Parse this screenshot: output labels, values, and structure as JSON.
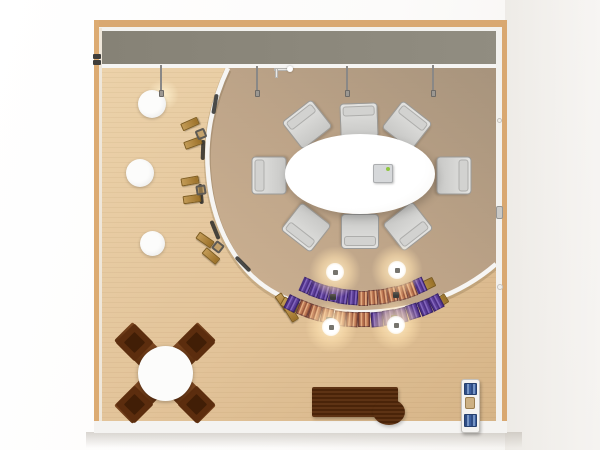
{
  "scene": {
    "view": "top-down 3d render of a conference room floor plan, no visible text",
    "palette": {
      "wood_trim": "#d9a871",
      "wall_gray": "#8b8779",
      "floor_light": "#e5c89f",
      "floor_light_2": "#d8b78c",
      "floor_inner": "#ab977f",
      "floor_inner_2": "#cbb08f",
      "partition_white": "#f6f5f3",
      "purple_dark": "#4c2f85",
      "purple_light": "#8366bc",
      "coral_dark": "#9c5a3e",
      "coral_light": "#e2aa80",
      "tan_desk": "#b08440",
      "walnut": "#53290c",
      "book_blue": "#3c5f9e",
      "book_blue_dark": "#2f4d85",
      "chair_gray": "#d5d5d3",
      "chair_edge": "#9b9b99",
      "device_led": "#8fc641",
      "glow": "#ffe3b3"
    },
    "seat_rows": [
      {
        "name": "auditorium-row-1",
        "cx": 363,
        "cy": 157,
        "r": 141,
        "a_start": 116,
        "a_end": 64,
        "count": 13,
        "seat_w": 10,
        "seat_h": 15,
        "pattern": [
          "P",
          "P",
          "P",
          "P",
          "P",
          "P",
          "C",
          "C",
          "C",
          "C",
          "C",
          "C",
          "P"
        ]
      },
      {
        "name": "auditorium-row-2",
        "cx": 363,
        "cy": 160,
        "r": 160,
        "a_start": 118.5,
        "a_end": 60.5,
        "count": 13,
        "seat_w": 12,
        "seat_h": 15,
        "pattern": [
          "P",
          "C",
          "C",
          "C",
          "C",
          "C",
          "C",
          "P",
          "P",
          "P",
          "P",
          "P",
          "P"
        ]
      }
    ],
    "items": [
      {
        "name": "pendant-glow",
        "cls": "glow-warm",
        "cx": 163,
        "cy": 95,
        "w": 34,
        "h": 30,
        "z": 2,
        "inter": false
      },
      {
        "name": "stool-1",
        "cls": "stool",
        "cx": 152,
        "cy": 104,
        "w": 28,
        "h": 28,
        "z": 3,
        "inter": true
      },
      {
        "name": "stool-2",
        "cls": "stool",
        "cx": 140,
        "cy": 173,
        "w": 28,
        "h": 28,
        "z": 3,
        "inter": true
      },
      {
        "name": "stool-3",
        "cls": "stool",
        "cx": 152,
        "cy": 243,
        "w": 25,
        "h": 25,
        "z": 3,
        "inter": true
      },
      {
        "name": "pendant-stem-1",
        "cls": "stem",
        "cx": 161,
        "cy": 78,
        "w": 2,
        "h": 27,
        "z": 5,
        "inter": false
      },
      {
        "name": "pendant-bulb-1",
        "cls": "bulb",
        "cx": 161,
        "cy": 93,
        "w": 5,
        "h": 7,
        "z": 5,
        "inter": true
      },
      {
        "name": "pendant-stem-2",
        "cls": "stem",
        "cx": 257,
        "cy": 79,
        "w": 2,
        "h": 27,
        "z": 5,
        "inter": false
      },
      {
        "name": "pendant-bulb-2",
        "cls": "bulb",
        "cx": 257,
        "cy": 93,
        "w": 5,
        "h": 7,
        "z": 5,
        "inter": true
      },
      {
        "name": "pendant-stem-3",
        "cls": "stem",
        "cx": 347,
        "cy": 79,
        "w": 2,
        "h": 27,
        "z": 5,
        "inter": false
      },
      {
        "name": "pendant-bulb-3",
        "cls": "bulb",
        "cx": 347,
        "cy": 93,
        "w": 5,
        "h": 7,
        "z": 5,
        "inter": true
      },
      {
        "name": "pendant-stem-4",
        "cls": "stem",
        "cx": 433,
        "cy": 78,
        "w": 2,
        "h": 27,
        "z": 5,
        "inter": false
      },
      {
        "name": "pendant-bulb-4",
        "cls": "bulb",
        "cx": 433,
        "cy": 93,
        "w": 5,
        "h": 7,
        "z": 5,
        "inter": true
      },
      {
        "name": "wall-bracket-arm",
        "cls": "bracket",
        "cx": 282,
        "cy": 69,
        "w": 16,
        "h": 3,
        "z": 5,
        "inter": false
      },
      {
        "name": "wall-bracket-post",
        "cls": "bracket",
        "cx": 276,
        "cy": 73,
        "w": 3,
        "h": 10,
        "z": 5,
        "inter": false
      },
      {
        "name": "wall-bracket-ball",
        "cls": "ball",
        "cx": 290,
        "cy": 69,
        "w": 6,
        "h": 6,
        "z": 5,
        "inter": false
      },
      {
        "name": "conference-table",
        "cls": "oval-table",
        "cx": 360,
        "cy": 174,
        "w": 150,
        "h": 80,
        "z": 4,
        "inter": true
      },
      {
        "name": "table-device",
        "cls": "device",
        "cx": 383,
        "cy": 173,
        "w": 20,
        "h": 19,
        "z": 5,
        "inter": true
      },
      {
        "name": "conference-chair-1",
        "cls": "chair",
        "cx": 307,
        "cy": 124,
        "w": 38,
        "h": 35,
        "rot": -38,
        "z": 3,
        "inter": true
      },
      {
        "name": "conference-chair-2",
        "cls": "chair",
        "cx": 359,
        "cy": 120,
        "w": 38,
        "h": 35,
        "rot": -2,
        "z": 3,
        "inter": true
      },
      {
        "name": "conference-chair-3",
        "cls": "chair",
        "cx": 407,
        "cy": 125,
        "w": 38,
        "h": 35,
        "rot": 38,
        "z": 3,
        "inter": true
      },
      {
        "name": "conference-chair-4",
        "cls": "chair",
        "cx": 269,
        "cy": 175,
        "w": 38,
        "h": 35,
        "rot": -90,
        "z": 3,
        "inter": true
      },
      {
        "name": "conference-chair-5",
        "cls": "chair",
        "cx": 454,
        "cy": 175,
        "w": 38,
        "h": 35,
        "rot": 90,
        "z": 3,
        "inter": true
      },
      {
        "name": "conference-chair-6",
        "cls": "chair",
        "cx": 306,
        "cy": 227,
        "w": 38,
        "h": 35,
        "rot": -142,
        "z": 3,
        "inter": true
      },
      {
        "name": "conference-chair-7",
        "cls": "chair",
        "cx": 360,
        "cy": 231,
        "w": 38,
        "h": 35,
        "rot": 180,
        "z": 3,
        "inter": true
      },
      {
        "name": "conference-chair-8",
        "cls": "chair",
        "cx": 408,
        "cy": 226,
        "w": 38,
        "h": 35,
        "rot": 142,
        "z": 3,
        "inter": true
      },
      {
        "name": "curve-desk-1a",
        "cls": "slat",
        "cx": 190,
        "cy": 124,
        "w": 18,
        "h": 8,
        "rot": -24,
        "z": 3,
        "inter": true
      },
      {
        "name": "curve-desk-1b",
        "cls": "slat",
        "cx": 193,
        "cy": 143,
        "w": 18,
        "h": 8,
        "rot": -20,
        "z": 3,
        "inter": true
      },
      {
        "name": "curve-chair-1",
        "cls": "mini-chair",
        "cx": 201,
        "cy": 134,
        "w": 10,
        "h": 10,
        "rot": -22,
        "z": 3,
        "inter": true
      },
      {
        "name": "curve-desk-2a",
        "cls": "slat",
        "cx": 190,
        "cy": 181,
        "w": 18,
        "h": 8,
        "rot": -10,
        "z": 3,
        "inter": true
      },
      {
        "name": "curve-desk-2b",
        "cls": "slat",
        "cx": 192,
        "cy": 199,
        "w": 18,
        "h": 8,
        "rot": -8,
        "z": 3,
        "inter": true
      },
      {
        "name": "curve-chair-2",
        "cls": "mini-chair",
        "cx": 201,
        "cy": 190,
        "w": 10,
        "h": 10,
        "rot": -9,
        "z": 3,
        "inter": true
      },
      {
        "name": "curve-desk-3a",
        "cls": "slat",
        "cx": 205,
        "cy": 240,
        "w": 18,
        "h": 8,
        "rot": 35,
        "z": 3,
        "inter": true
      },
      {
        "name": "curve-desk-3b",
        "cls": "slat",
        "cx": 211,
        "cy": 256,
        "w": 18,
        "h": 8,
        "rot": 40,
        "z": 3,
        "inter": true
      },
      {
        "name": "curve-chair-3",
        "cls": "mini-chair",
        "cx": 218,
        "cy": 247,
        "w": 10,
        "h": 10,
        "rot": 38,
        "z": 3,
        "inter": true
      },
      {
        "name": "curve-desk-4a",
        "cls": "slat",
        "cx": 283,
        "cy": 302,
        "w": 18,
        "h": 8,
        "rot": 55,
        "z": 3,
        "inter": true
      },
      {
        "name": "curve-desk-4b",
        "cls": "slat",
        "cx": 291,
        "cy": 313,
        "w": 18,
        "h": 8,
        "rot": 58,
        "z": 3,
        "inter": true
      },
      {
        "name": "curve-chair-4",
        "cls": "mini-chair",
        "cx": 296,
        "cy": 306,
        "w": 10,
        "h": 10,
        "rot": 56,
        "z": 3,
        "inter": true
      },
      {
        "name": "inner-trim-1",
        "cls": "dark-arc",
        "cx": 215,
        "cy": 104,
        "w": 20,
        "h": 4,
        "rot": 100,
        "z": 2,
        "inter": false
      },
      {
        "name": "inner-trim-2",
        "cls": "dark-arc",
        "cx": 203,
        "cy": 150,
        "w": 20,
        "h": 4,
        "rot": 92,
        "z": 2,
        "inter": false
      },
      {
        "name": "inner-trim-3",
        "cls": "dark-arc",
        "cx": 201,
        "cy": 194,
        "w": 20,
        "h": 4,
        "rot": 85,
        "z": 2,
        "inter": false
      },
      {
        "name": "inner-trim-4",
        "cls": "dark-arc",
        "cx": 215,
        "cy": 230,
        "w": 20,
        "h": 4,
        "rot": 68,
        "z": 2,
        "inter": false
      },
      {
        "name": "inner-trim-5",
        "cls": "dark-arc",
        "cx": 243,
        "cy": 264,
        "w": 20,
        "h": 4,
        "rot": 45,
        "z": 2,
        "inter": false
      },
      {
        "name": "cafe-x-bar-1",
        "cls": "xbar",
        "cx": 165,
        "cy": 373,
        "w": 118,
        "h": 26,
        "rot": 45,
        "z": 2,
        "inter": true
      },
      {
        "name": "cafe-x-bar-2",
        "cls": "xbar",
        "cx": 165,
        "cy": 373,
        "w": 118,
        "h": 26,
        "rot": -45,
        "z": 2,
        "inter": true
      },
      {
        "name": "cafe-seat-1",
        "cls": "diamond",
        "cx": 134,
        "cy": 342,
        "w": 27,
        "h": 27,
        "rot": 45,
        "z": 3,
        "inter": true
      },
      {
        "name": "cafe-seat-2",
        "cls": "diamond",
        "cx": 196,
        "cy": 342,
        "w": 27,
        "h": 27,
        "rot": 45,
        "z": 3,
        "inter": true
      },
      {
        "name": "cafe-seat-3",
        "cls": "diamond",
        "cx": 134,
        "cy": 404,
        "w": 27,
        "h": 27,
        "rot": 45,
        "z": 3,
        "inter": true
      },
      {
        "name": "cafe-seat-4",
        "cls": "diamond",
        "cx": 196,
        "cy": 404,
        "w": 27,
        "h": 27,
        "rot": 45,
        "z": 3,
        "inter": true
      },
      {
        "name": "cafe-seat-1-cushion",
        "cls": "diamond-inner",
        "cx": 134,
        "cy": 342,
        "w": 15,
        "h": 15,
        "rot": 45,
        "z": 3,
        "inter": false
      },
      {
        "name": "cafe-seat-2-cushion",
        "cls": "diamond-inner",
        "cx": 196,
        "cy": 342,
        "w": 15,
        "h": 15,
        "rot": 45,
        "z": 3,
        "inter": false
      },
      {
        "name": "cafe-seat-3-cushion",
        "cls": "diamond-inner",
        "cx": 134,
        "cy": 404,
        "w": 15,
        "h": 15,
        "rot": 45,
        "z": 3,
        "inter": false
      },
      {
        "name": "cafe-seat-4-cushion",
        "cls": "diamond-inner",
        "cx": 196,
        "cy": 404,
        "w": 15,
        "h": 15,
        "rot": 45,
        "z": 3,
        "inter": false
      },
      {
        "name": "cafe-round-table",
        "cls": "circle-table",
        "cx": 165,
        "cy": 373,
        "w": 55,
        "h": 55,
        "z": 4,
        "inter": true
      },
      {
        "name": "credenza-desk",
        "cls": "desk",
        "cx": 355,
        "cy": 402,
        "w": 86,
        "h": 30,
        "z": 3,
        "inter": true
      },
      {
        "name": "credenza-desk-bulge",
        "cls": "desk-bulge",
        "cx": 389,
        "cy": 412,
        "w": 32,
        "h": 26,
        "z": 3,
        "inter": false
      },
      {
        "name": "bookshelf",
        "cls": "shelf",
        "cx": 470,
        "cy": 406,
        "w": 19,
        "h": 54,
        "z": 3,
        "inter": true
      },
      {
        "name": "bookshelf-books-top",
        "cls": "books",
        "cx": 470,
        "cy": 389,
        "w": 13,
        "h": 12,
        "z": 4,
        "inter": false
      },
      {
        "name": "bookshelf-plant",
        "cls": "plant",
        "cx": 470,
        "cy": 403,
        "w": 10,
        "h": 12,
        "z": 4,
        "inter": false
      },
      {
        "name": "bookshelf-books-bottom",
        "cls": "books",
        "cx": 470,
        "cy": 420,
        "w": 13,
        "h": 13,
        "z": 4,
        "inter": false
      },
      {
        "name": "door-handle",
        "cls": "handle",
        "cx": 499,
        "cy": 212,
        "w": 7,
        "h": 13,
        "z": 4,
        "inter": true
      },
      {
        "name": "wall-knob-1",
        "cls": "wall-dot",
        "cx": 499,
        "cy": 120,
        "w": 5,
        "h": 5,
        "z": 4,
        "inter": false
      },
      {
        "name": "wall-knob-2",
        "cls": "wall-dot",
        "cx": 500,
        "cy": 287,
        "w": 6,
        "h": 6,
        "z": 4,
        "inter": false
      },
      {
        "name": "wall-latch-1",
        "cls": "latch",
        "cx": 97,
        "cy": 56,
        "w": 8,
        "h": 5,
        "z": 4,
        "inter": false
      },
      {
        "name": "wall-latch-2",
        "cls": "latch",
        "cx": 97,
        "cy": 62,
        "w": 8,
        "h": 5,
        "z": 4,
        "inter": false
      },
      {
        "name": "row-end-table-1",
        "cls": "cap",
        "cx": 426,
        "cy": 285,
        "w": 17,
        "h": 10,
        "rot": -26,
        "z": 4,
        "inter": true
      },
      {
        "name": "row-end-table-2",
        "cls": "cap",
        "cx": 289,
        "cy": 305,
        "w": 17,
        "h": 10,
        "rot": 30,
        "z": 4,
        "inter": true
      },
      {
        "name": "row-end-table-3",
        "cls": "cap",
        "cx": 439,
        "cy": 302,
        "w": 17,
        "h": 10,
        "rot": -32,
        "z": 4,
        "inter": true
      },
      {
        "name": "row-connector-1",
        "cls": "connector",
        "cx": 333,
        "cy": 297,
        "w": 6,
        "h": 6,
        "z": 5,
        "inter": false
      },
      {
        "name": "row-connector-2",
        "cls": "connector",
        "cx": 396,
        "cy": 295,
        "w": 6,
        "h": 6,
        "z": 5,
        "inter": false
      },
      {
        "name": "row-connector-3",
        "cls": "connector",
        "cx": 329,
        "cy": 320,
        "w": 6,
        "h": 6,
        "z": 5,
        "inter": false
      },
      {
        "name": "row-connector-4",
        "cls": "connector",
        "cx": 394,
        "cy": 318,
        "w": 6,
        "h": 6,
        "z": 5,
        "inter": false
      },
      {
        "name": "ceiling-light-halo-1",
        "cls": "halo",
        "cx": 335,
        "cy": 272,
        "w": 52,
        "h": 52,
        "z": 6,
        "inter": false
      },
      {
        "name": "ceiling-light-halo-2",
        "cls": "halo",
        "cx": 397,
        "cy": 270,
        "w": 52,
        "h": 52,
        "z": 6,
        "inter": false
      },
      {
        "name": "ceiling-light-halo-3",
        "cls": "halo",
        "cx": 331,
        "cy": 327,
        "w": 52,
        "h": 52,
        "z": 6,
        "inter": false
      },
      {
        "name": "ceiling-light-halo-4",
        "cls": "halo",
        "cx": 396,
        "cy": 325,
        "w": 52,
        "h": 52,
        "z": 6,
        "inter": false
      },
      {
        "name": "ceiling-light-1",
        "cls": "core",
        "cx": 335,
        "cy": 272,
        "w": 18,
        "h": 18,
        "z": 7,
        "inter": true
      },
      {
        "name": "ceiling-light-2",
        "cls": "core",
        "cx": 397,
        "cy": 270,
        "w": 18,
        "h": 18,
        "z": 7,
        "inter": true
      },
      {
        "name": "ceiling-light-3",
        "cls": "core",
        "cx": 331,
        "cy": 327,
        "w": 18,
        "h": 18,
        "z": 7,
        "inter": true
      },
      {
        "name": "ceiling-light-4",
        "cls": "core",
        "cx": 396,
        "cy": 325,
        "w": 18,
        "h": 18,
        "z": 7,
        "inter": true
      },
      {
        "name": "ceiling-light-mount-1",
        "cls": "fixture",
        "cx": 335,
        "cy": 272,
        "w": 5,
        "h": 5,
        "z": 8,
        "inter": false
      },
      {
        "name": "ceiling-light-mount-2",
        "cls": "fixture",
        "cx": 397,
        "cy": 270,
        "w": 5,
        "h": 5,
        "z": 8,
        "inter": false
      },
      {
        "name": "ceiling-light-mount-3",
        "cls": "fixture",
        "cx": 331,
        "cy": 327,
        "w": 5,
        "h": 5,
        "z": 8,
        "inter": false
      },
      {
        "name": "ceiling-light-mount-4",
        "cls": "fixture",
        "cx": 396,
        "cy": 325,
        "w": 5,
        "h": 5,
        "z": 8,
        "inter": false
      }
    ]
  }
}
